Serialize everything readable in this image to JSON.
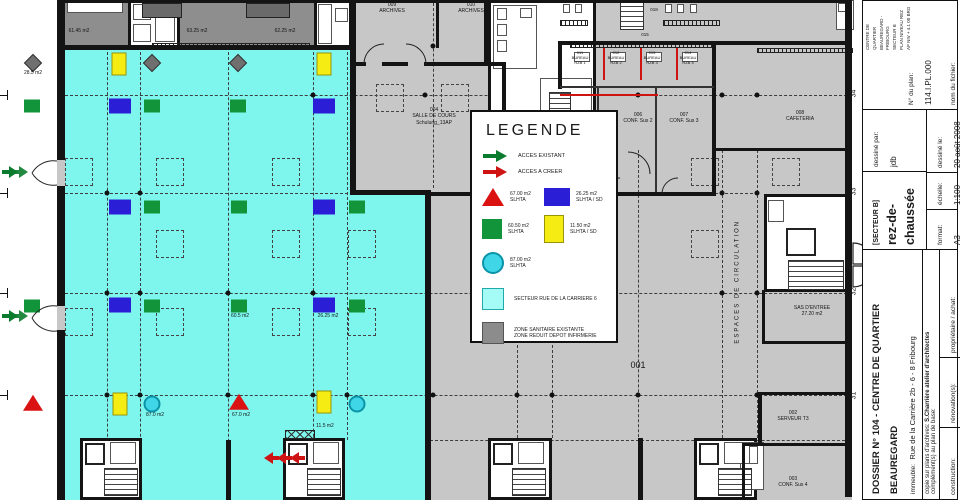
{
  "legend": {
    "title": "LEGENDE",
    "acces_existant": "ACCES EXISTANT",
    "acces_a_creer": "ACCES A CREER",
    "tri_area": "67.00 m2",
    "tri_cls": "SLHTA",
    "blue_area": "26.25 m2",
    "blue_cls": "SLHTA / SD",
    "green_area": "60.50 m2",
    "green_cls": "SLHTA",
    "yellow_area": "11.50 m2",
    "yellow_cls": "SLHTA / SD",
    "circle_area": "87.00 m2",
    "circle_cls": "SLHTA",
    "secteur": "SECTEUR RUE DE LA CARRIERE 6",
    "zone1": "ZONE SANITAIRE EXISTANTE",
    "zone2": "ZONE REDUIT DEPOT INFIRMERIE"
  },
  "plan": {
    "labels": [
      {
        "t": "61.45 m2",
        "x": 58,
        "y": 28,
        "w": 42,
        "s": 5
      },
      {
        "t": "63.25 m2",
        "x": 176,
        "y": 28,
        "w": 42,
        "s": 5
      },
      {
        "t": "62.25 m2",
        "x": 264,
        "y": 28,
        "w": 42,
        "s": 5
      },
      {
        "t": "28.5 m2",
        "x": 14,
        "y": 70,
        "w": 38,
        "s": 5
      },
      {
        "t": "009\nARCHIVES",
        "x": 371,
        "y": 2,
        "w": 42,
        "s": 5
      },
      {
        "t": "010\nARCHIVES",
        "x": 450,
        "y": 2,
        "w": 42,
        "s": 5
      },
      {
        "t": "018",
        "x": 644,
        "y": 7,
        "w": 20,
        "s": 4.5
      },
      {
        "t": "015",
        "x": 635,
        "y": 32,
        "w": 20,
        "s": 4.5
      },
      {
        "t": "011\nBUREAU\nRZB 1",
        "x": 566,
        "y": 50,
        "w": 28,
        "s": 4
      },
      {
        "t": "012\nBUREAU\nRZB 2",
        "x": 602,
        "y": 50,
        "w": 28,
        "s": 4
      },
      {
        "t": "013\nBUREAU\nRZB 3",
        "x": 638,
        "y": 50,
        "w": 28,
        "s": 4
      },
      {
        "t": "014\nBUREAU\nRZB 4",
        "x": 674,
        "y": 50,
        "w": 28,
        "s": 4
      },
      {
        "t": "004\nSALLE DE COURS\nSchulung_13AP",
        "x": 395,
        "y": 107,
        "w": 78,
        "s": 5
      },
      {
        "t": "006\nCONF. Sus 2",
        "x": 614,
        "y": 112,
        "w": 48,
        "s": 5
      },
      {
        "t": "007\nCONF. Sus 3",
        "x": 660,
        "y": 112,
        "w": 48,
        "s": 5
      },
      {
        "t": "008\nCAFETERIA",
        "x": 774,
        "y": 110,
        "w": 52,
        "s": 5
      },
      {
        "t": "60.5 m2",
        "x": 222,
        "y": 313,
        "w": 36,
        "s": 5
      },
      {
        "t": "26.25 m2",
        "x": 308,
        "y": 313,
        "w": 40,
        "s": 5
      },
      {
        "t": "87.0 m2",
        "x": 138,
        "y": 412,
        "w": 34,
        "s": 5
      },
      {
        "t": "67.0 m2",
        "x": 224,
        "y": 412,
        "w": 34,
        "s": 5
      },
      {
        "t": "11.5 m2",
        "x": 308,
        "y": 423,
        "w": 34,
        "s": 5
      },
      {
        "t": "001",
        "x": 620,
        "y": 360,
        "w": 36,
        "s": 9
      },
      {
        "t": "SAS D'ENTREE\n27.20 m2",
        "x": 780,
        "y": 305,
        "w": 64,
        "s": 5
      },
      {
        "t": "002\nSERVEUR T3",
        "x": 766,
        "y": 410,
        "w": 54,
        "s": 5
      },
      {
        "t": "003\nCONF. Sus 4",
        "x": 766,
        "y": 476,
        "w": 54,
        "s": 5
      },
      {
        "t": "ESPACES DE CIRCULATION",
        "x": 668,
        "y": 278,
        "w": 140,
        "s": 6,
        "rot": -90,
        "ls": 2
      }
    ],
    "axis_labels": [
      {
        "t": "34",
        "x": 850,
        "y": 90
      },
      {
        "t": "33",
        "x": 850,
        "y": 188
      },
      {
        "t": "32",
        "x": 850,
        "y": 288
      },
      {
        "t": "31",
        "x": 850,
        "y": 392
      }
    ],
    "markers": [
      {
        "t": "diamond",
        "x": 33,
        "y": 63
      },
      {
        "t": "yellow",
        "x": 119,
        "y": 64
      },
      {
        "t": "diamond",
        "x": 152,
        "y": 63
      },
      {
        "t": "diamond",
        "x": 238,
        "y": 63
      },
      {
        "t": "yellow",
        "x": 324,
        "y": 64
      },
      {
        "t": "green",
        "x": 32,
        "y": 106
      },
      {
        "t": "blue",
        "x": 120,
        "y": 106
      },
      {
        "t": "green",
        "x": 152,
        "y": 106
      },
      {
        "t": "green",
        "x": 238,
        "y": 106
      },
      {
        "t": "blue",
        "x": 324,
        "y": 106
      },
      {
        "t": "blue",
        "x": 120,
        "y": 207
      },
      {
        "t": "green",
        "x": 152,
        "y": 207
      },
      {
        "t": "green",
        "x": 239,
        "y": 207
      },
      {
        "t": "blue",
        "x": 324,
        "y": 207
      },
      {
        "t": "green",
        "x": 357,
        "y": 207
      },
      {
        "t": "green",
        "x": 32,
        "y": 306
      },
      {
        "t": "blue",
        "x": 120,
        "y": 305
      },
      {
        "t": "green",
        "x": 152,
        "y": 306
      },
      {
        "t": "green",
        "x": 239,
        "y": 306
      },
      {
        "t": "blue",
        "x": 324,
        "y": 305
      },
      {
        "t": "green",
        "x": 357,
        "y": 306
      },
      {
        "t": "triangle",
        "x": 33,
        "y": 404
      },
      {
        "t": "yellow",
        "x": 120,
        "y": 404
      },
      {
        "t": "circle",
        "x": 152,
        "y": 404
      },
      {
        "t": "triangle",
        "x": 239,
        "y": 403
      },
      {
        "t": "yellow",
        "x": 324,
        "y": 402
      },
      {
        "t": "circle",
        "x": 357,
        "y": 404
      }
    ]
  },
  "titleblock": {
    "dossier": "DOSSIER N°  104 - CENTRE DE QUARTIER BEAUREGARD",
    "building_label": "immeuble:",
    "building": "Rue de la Carrière 2b - 6 - 8   Fribourg",
    "copy_label": "copie sur plans d'archives:",
    "copy": "S.Charrière atelier d'architectes",
    "complement_label": "complément(s) au plan de base:",
    "construction_label": "construction:",
    "construction": "1999",
    "renovation_label": "rénovation(s):",
    "renovation": "",
    "owner_label": "propriétaire / achat:",
    "owner": "CPPEF",
    "sector": "[SECTEUR B]",
    "level": "rez-de-chaussée",
    "drawn_by_label": "dessiné par:",
    "drawn_by": "jdb",
    "drawn_on_label": "dessiné le:",
    "drawn_on": "20 août 2008",
    "format_label": "format:",
    "format": "A3",
    "scale_label": "échelle:",
    "scale": "1:100",
    "project_line1": "CENTRE DE QUARTIER BEAUREGARD - FRIBOURG",
    "project_line2": "SECTEUR B",
    "project_line3": "PLAN NIVEAU REZ AP    NIV + 4.1 00 BRG",
    "plan_no_label": "N° du plan:",
    "plan_no": "114.I.PL.000",
    "file_label": "nom du fichier:",
    "file": "114.I.000.A3 pdf",
    "margin_note": "200",
    "disclaimer": "...des différences avec le bâtiment existant et ce dernier a priorité sur le plan."
  }
}
